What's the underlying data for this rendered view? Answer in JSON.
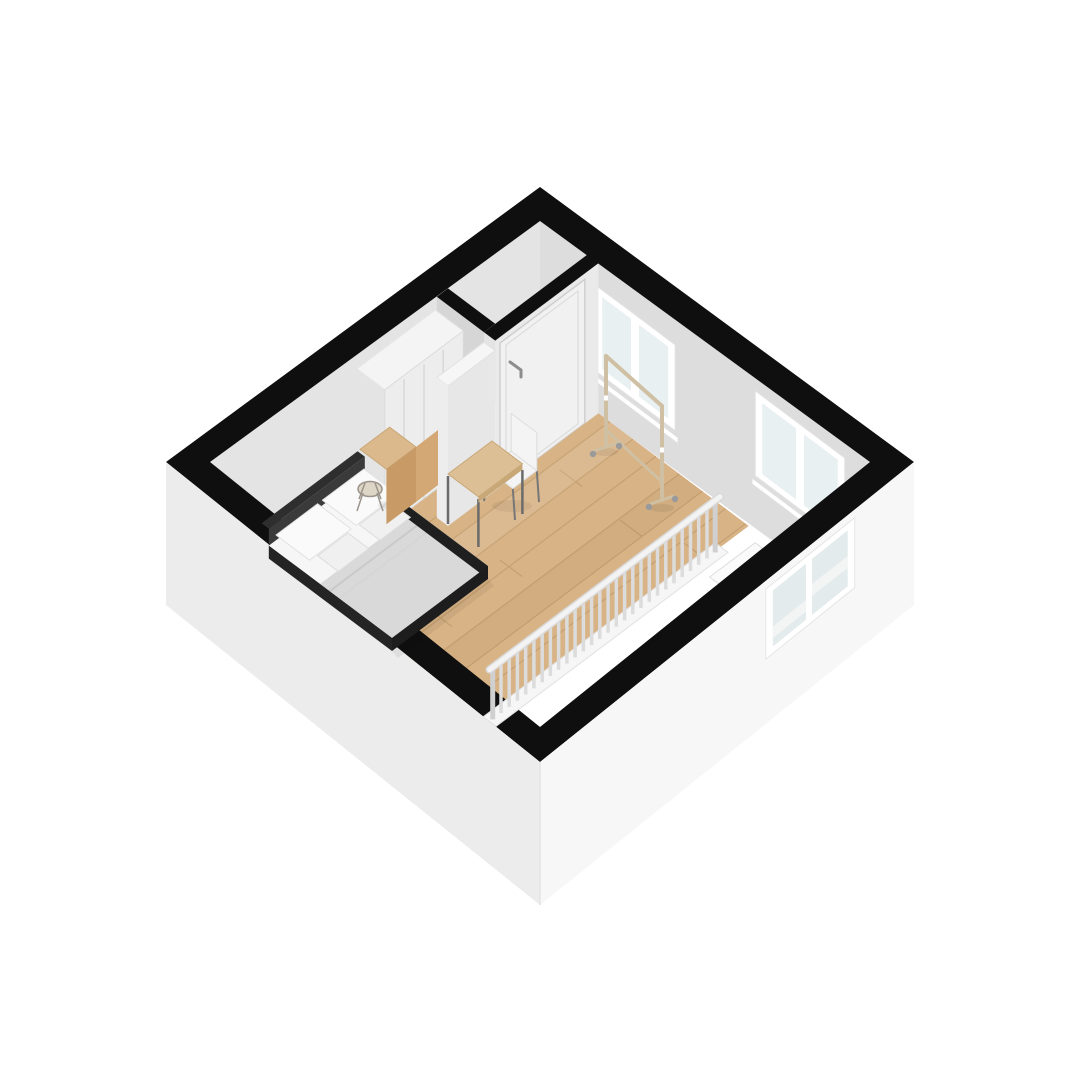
{
  "scene": {
    "kind": "isometric-3d-floorplan",
    "floor": "attic studio with stair void",
    "rooms": [
      "bedroom",
      "main-room",
      "entry-closet",
      "stairwell"
    ],
    "furniture": [
      "double-bed",
      "wardrobe",
      "nightstand",
      "wire-stool",
      "room-divider",
      "desk",
      "desk-chair",
      "clothes-rack"
    ],
    "windows": {
      "northeast_wall": 2,
      "lower_southeast_wall": 1
    },
    "railing": {
      "balusters": 28
    },
    "stairs": {
      "visible_steps": 3
    }
  },
  "colors": {
    "background": "#ffffff",
    "wallTop": "#0f0f0f",
    "wallInnerNW": "#e4e4e4",
    "wallInnerNE": "#dddddd",
    "wallDoorFace": "#eaeaea",
    "wallSideFace": "#d6d6d6",
    "closetInterior": "#e9e9e9",
    "shelf": "#f2f2f2",
    "partitionFace": "#e7e7e7",
    "partitionTop": "#f6f6f6",
    "partitionEnd": "#ededed",
    "extSW": "#ececec",
    "extSE": "#f7f7f7",
    "floorWood": "#d8b385",
    "plankSeam": "#c5a071",
    "void": "#ffffff",
    "stepTop": "#fafafa",
    "stepRiser": "#e4e4e4",
    "railBase": "#f6f6f6",
    "baluster": "#dcdcdc",
    "railTop": "#f3f3f3",
    "windowFrame": "#ffffff",
    "glass": "#e9f0f1",
    "glassLower": "#e4ebec",
    "stairBehindGlass": "#f3f5f5",
    "door": "#f1f1f1",
    "doorHandle": "#8d8d8d",
    "wardrobeFront": "#ededed",
    "wardrobeTop": "#f4f4f4",
    "wardrobeSide": "#e2e2e2",
    "headboard": "#2e2e2e",
    "bedFrame": "#1f1f1f",
    "mattress": "#f6f6f6",
    "blanket": "#d9d9d9",
    "pillow": "#fafafa",
    "cushion": "#f0f0f0",
    "nightstandTop": "#dcb98c",
    "nightstandSide": "#c89b66",
    "stoolSeat": "#ddd5c6",
    "stoolWire": "#9a948a",
    "deskTop": "#dcbf94",
    "deskEdge": "#c9a878",
    "deskLeg": "#6b6b6b",
    "chairShell": "#f4f4f4",
    "chairLeg": "#777777",
    "rackWood": "#cfc0a4",
    "caster": "#9a9a9a",
    "shadow": "rgba(0,0,0,0.06)"
  }
}
